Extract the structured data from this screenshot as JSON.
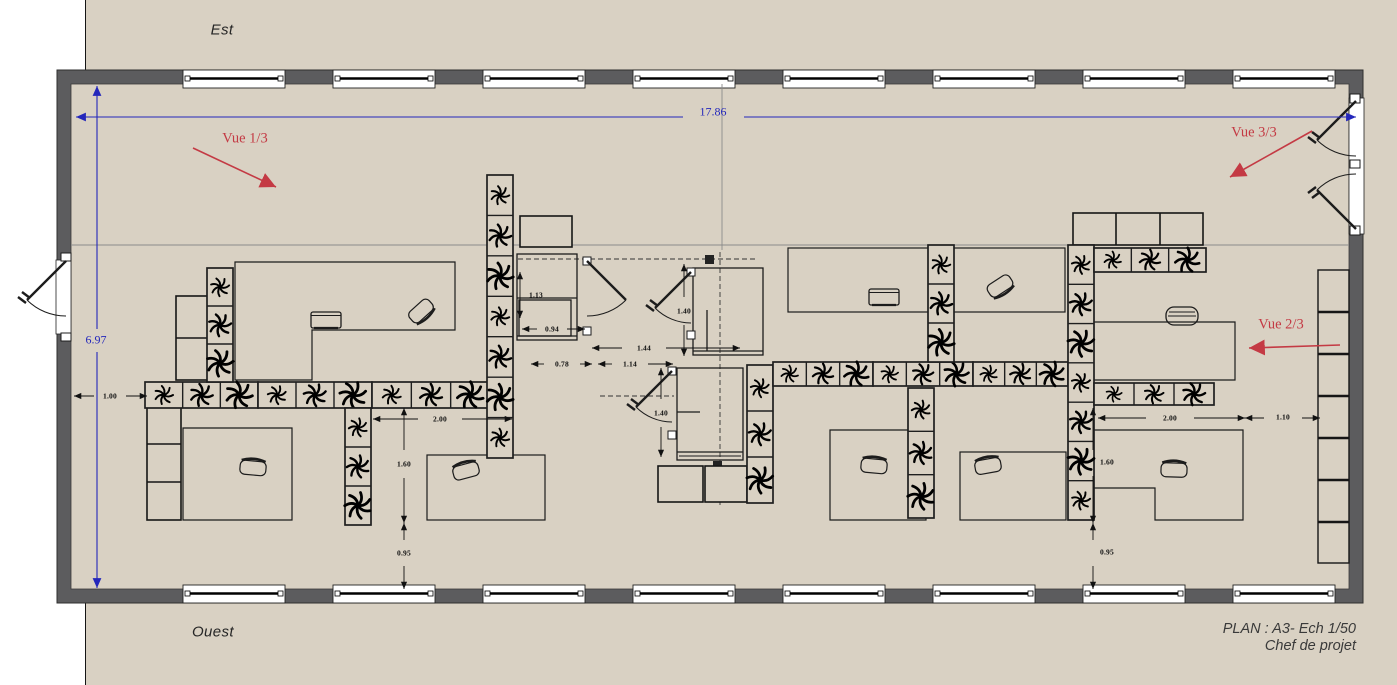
{
  "drawing": {
    "orientation_labels": {
      "top": "Est",
      "bottom": "Ouest"
    },
    "title_block": {
      "scale_line": "PLAN : A3- Ech 1/50",
      "author_line": "Chef de projet"
    },
    "overall_dimensions": {
      "width": {
        "label": "17.86",
        "x": 713,
        "y": 112
      },
      "height": {
        "label": "6.97",
        "x": 96,
        "y": 340
      }
    },
    "views": [
      {
        "label": "Vue 1/3",
        "x": 245,
        "y": 139,
        "arrow": [
          193,
          148,
          276,
          187
        ]
      },
      {
        "label": "Vue 2/3",
        "x": 1281,
        "y": 325,
        "arrow": [
          1340,
          345,
          1249,
          348
        ]
      },
      {
        "label": "Vue 3/3",
        "x": 1254,
        "y": 133,
        "arrow": [
          1312,
          131,
          1230,
          177
        ]
      }
    ],
    "dimension_labels": [
      {
        "text": "1.13",
        "x": 536,
        "y": 295
      },
      {
        "text": "0.94",
        "x": 552,
        "y": 329
      },
      {
        "text": "0.78",
        "x": 562,
        "y": 364
      },
      {
        "text": "1.44",
        "x": 644,
        "y": 348
      },
      {
        "text": "1.14",
        "x": 630,
        "y": 364
      },
      {
        "text": "1.40",
        "x": 684,
        "y": 311
      },
      {
        "text": "1.40",
        "x": 661,
        "y": 413
      },
      {
        "text": "1.00",
        "x": 110,
        "y": 396
      },
      {
        "text": "2.00",
        "x": 440,
        "y": 419
      },
      {
        "text": "1.60",
        "x": 404,
        "y": 464
      },
      {
        "text": "0.95",
        "x": 404,
        "y": 553
      },
      {
        "text": "2.00",
        "x": 1170,
        "y": 418
      },
      {
        "text": "1.10",
        "x": 1283,
        "y": 417
      },
      {
        "text": "1.60",
        "x": 1107,
        "y": 462
      },
      {
        "text": "0.95",
        "x": 1107,
        "y": 552
      }
    ],
    "colors": {
      "paper": "#d9d1c3",
      "wall": "#5c5c5e",
      "dimension_blue": "#2427bb",
      "view_red": "#c43a44",
      "ink": "#1b1b1b"
    }
  }
}
